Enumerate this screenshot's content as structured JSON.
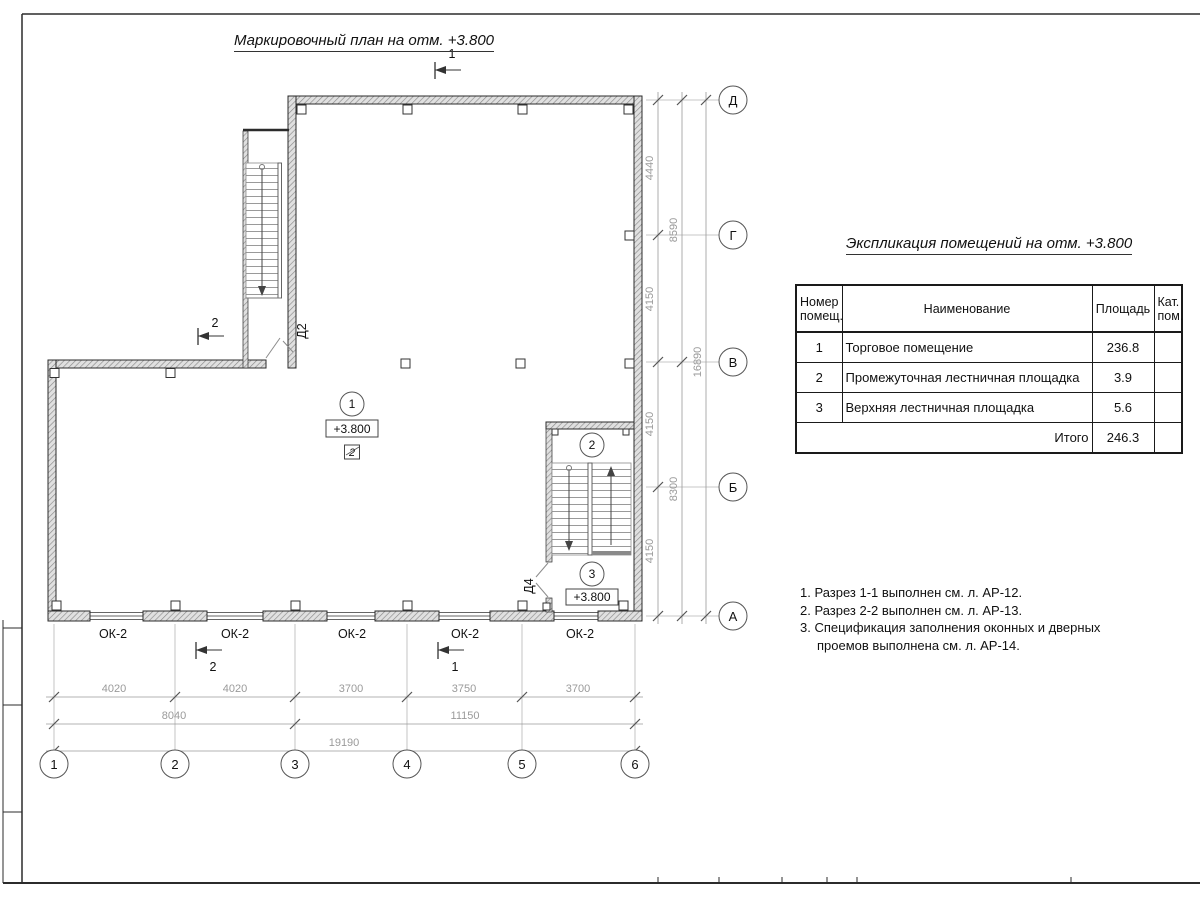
{
  "titles": {
    "plan": "Маркировочный план на отм. +3.800",
    "table": "Экспликация помещений на отм. +3.800"
  },
  "table": {
    "h_num": "Номер помещ.",
    "h_name": "Наименование",
    "h_area": "Площадь",
    "h_cat": "Кат. пом.",
    "rows": [
      {
        "n": "1",
        "name": "Торговое помещение",
        "area": "236.8",
        "cat": ""
      },
      {
        "n": "2",
        "name": "Промежуточная лестничная площадка",
        "area": "3.9",
        "cat": ""
      },
      {
        "n": "3",
        "name": "Верхняя лестничная площадка",
        "area": "5.6",
        "cat": ""
      }
    ],
    "total_label": "Итого",
    "total": "246.3"
  },
  "notes": {
    "line1": "1. Разрез 1-1 выполнен см. л. АР-12.",
    "line2": "2. Разрез 2-2 выполнен см. л. АР-13.",
    "line3": "3. Спецификация заполнения оконных и дверных",
    "line4": "проемов выполнена см. л. АР-14."
  },
  "axes": {
    "cols": [
      "1",
      "2",
      "3",
      "4",
      "5",
      "6"
    ],
    "rows": [
      "Д",
      "Г",
      "В",
      "Б",
      "А"
    ]
  },
  "dim_bottom": {
    "c1": [
      "4020",
      "4020",
      "3700",
      "3750",
      "3700"
    ],
    "c2": [
      "8040",
      "11150"
    ],
    "total": "19190"
  },
  "dim_right": {
    "c1": [
      "4440",
      "4150",
      "4150",
      "4150"
    ],
    "c2": [
      "8590",
      "8300"
    ],
    "total": "16890"
  },
  "rooms": {
    "r1": {
      "number": "1",
      "elevation": "+3.800",
      "floor_type": "2"
    },
    "r2": {
      "number": "2"
    },
    "r3": {
      "number": "3",
      "elevation": "+3.800"
    }
  },
  "doors": {
    "d2": "Д2",
    "d4": "Д4"
  },
  "windows": [
    "ОК-2",
    "ОК-2",
    "ОК-2",
    "ОК-2",
    "ОК-2"
  ],
  "sections": {
    "top": "1",
    "left": "2",
    "bottom_left": "2",
    "bottom_right": "1"
  },
  "colors": {
    "line": "#2b2b2b",
    "dim_text": "#9a9a9a",
    "wall_fill": "#e0e0e0"
  }
}
